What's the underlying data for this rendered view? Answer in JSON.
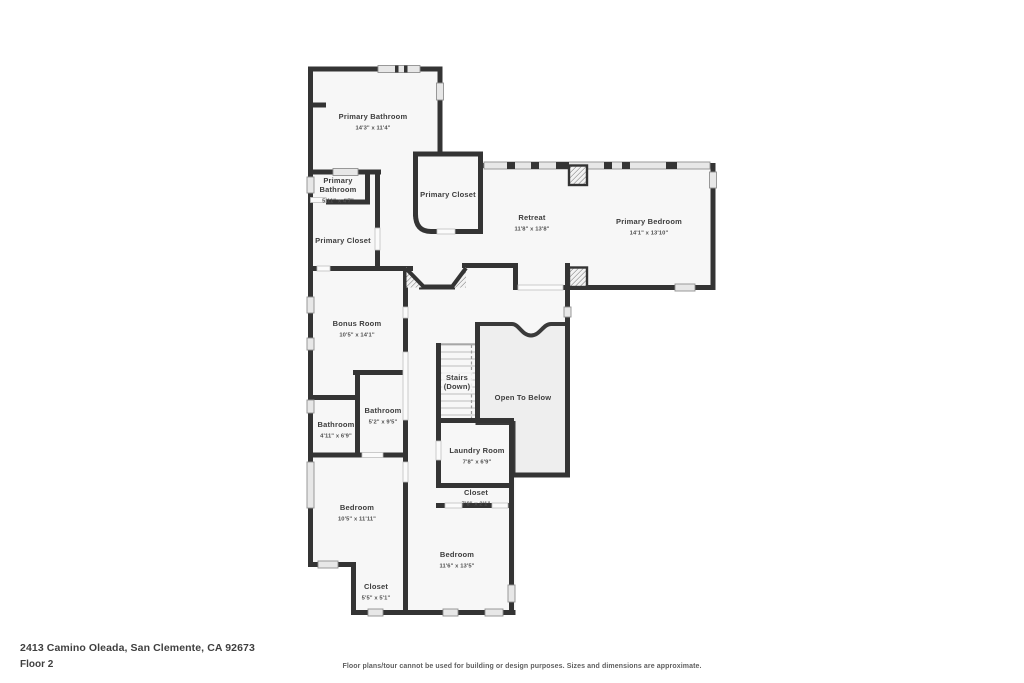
{
  "footer": {
    "address": "2413 Camino Oleada, San Clemente, CA 92673",
    "floor_label": "Floor 2",
    "disclaimer": "Floor plans/tour cannot be used for building or design purposes. Sizes and dimensions are approximate."
  },
  "floorplan": {
    "colors": {
      "wall": "#343434",
      "room_fill": "#f7f7f7",
      "open_below_fill": "#eeeeee",
      "window_fill": "#e7e7e7",
      "label_text": "#3d3d3d",
      "dim_text": "#4e4e4e"
    },
    "rooms": [
      {
        "id": "primary-bathroom",
        "lines": [
          "Primary Bathroom"
        ],
        "dims": "14'3\" x 11'4\"",
        "x": 373,
        "y": 119
      },
      {
        "id": "primary-bathroom-2",
        "lines": [
          "Primary",
          "Bathroom"
        ],
        "dims": "5'11\" x 4'7\"",
        "x": 338,
        "y": 183
      },
      {
        "id": "primary-closet-1",
        "lines": [
          "Primary Closet"
        ],
        "x": 343,
        "y": 243
      },
      {
        "id": "primary-closet-2",
        "lines": [
          "Primary Closet"
        ],
        "x": 448,
        "y": 197
      },
      {
        "id": "retreat",
        "lines": [
          "Retreat"
        ],
        "dims": "11'8\" x 13'8\"",
        "x": 532,
        "y": 220
      },
      {
        "id": "primary-bedroom",
        "lines": [
          "Primary Bedroom"
        ],
        "dims": "14'1\" x 13'10\"",
        "x": 649,
        "y": 224
      },
      {
        "id": "bonus-room",
        "lines": [
          "Bonus Room"
        ],
        "dims": "10'5\" x 14'1\"",
        "x": 357,
        "y": 326
      },
      {
        "id": "bathroom-1",
        "lines": [
          "Bathroom"
        ],
        "dims": "5'2\" x 9'5\"",
        "x": 383,
        "y": 413
      },
      {
        "id": "bathroom-2",
        "lines": [
          "Bathroom"
        ],
        "dims": "4'11\" x 6'9\"",
        "x": 336,
        "y": 427
      },
      {
        "id": "stairs",
        "lines": [
          "Stairs",
          "(Down)"
        ],
        "x": 457,
        "y": 380
      },
      {
        "id": "open-to-below",
        "lines": [
          "Open To Below"
        ],
        "x": 523,
        "y": 400
      },
      {
        "id": "laundry-room",
        "lines": [
          "Laundry Room"
        ],
        "dims": "7'8\" x 6'9\"",
        "x": 477,
        "y": 453
      },
      {
        "id": "closet-1",
        "lines": [
          "Closet"
        ],
        "dims": "7'8\" x 2'1\"",
        "x": 476,
        "y": 495
      },
      {
        "id": "bedroom-1",
        "lines": [
          "Bedroom"
        ],
        "dims": "10'5\" x 11'11\"",
        "x": 357,
        "y": 510
      },
      {
        "id": "closet-2",
        "lines": [
          "Closet"
        ],
        "dims": "5'5\" x 5'1\"",
        "x": 376,
        "y": 589
      },
      {
        "id": "bedroom-2",
        "lines": [
          "Bedroom"
        ],
        "dims": "11'6\" x 13'5\"",
        "x": 457,
        "y": 557
      }
    ]
  }
}
